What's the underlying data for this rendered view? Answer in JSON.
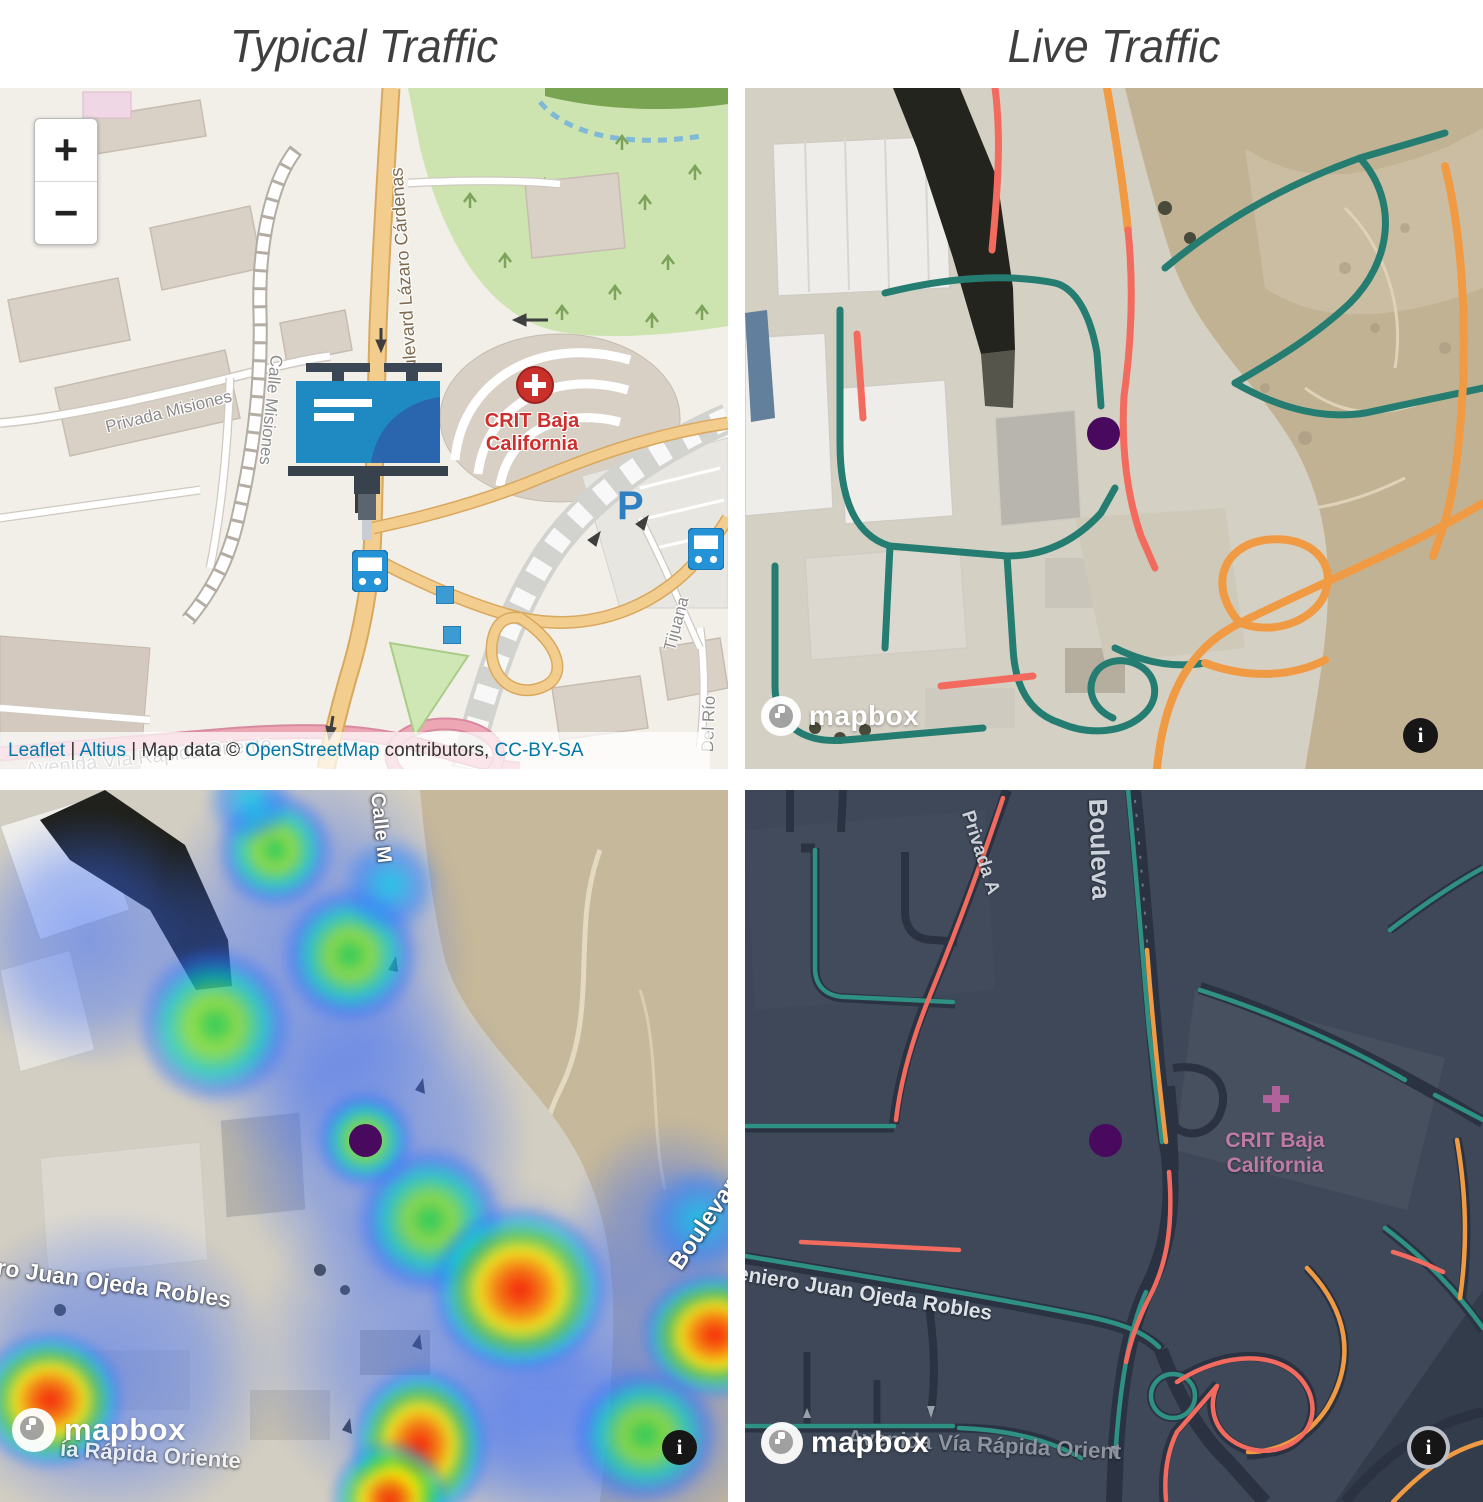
{
  "titles": {
    "typical": "Typical Traffic",
    "live": "Live Traffic"
  },
  "colors": {
    "traffic_teal": "#257d72",
    "traffic_orange": "#f09b43",
    "traffic_red": "#f26b5e",
    "marker_purple": "#49095f",
    "dark_map_bg": "#3e4858",
    "osm_main_road": "#f3cd8d",
    "osm_fast_road_pink": "#eda6b4",
    "park_green": "#cde4b0",
    "link_blue": "#0078a8",
    "poi_red": "#cc2f2c",
    "poi_pink": "#c07ba4"
  },
  "osm_map": {
    "zoom_in": "+",
    "zoom_out": "−",
    "poi_crit": "CRIT Baja California",
    "parking": "P",
    "street_privada_misiones": "Privada Misiones",
    "street_calle_misiones": "Calle Misiones",
    "street_boulevard": "Boulevard Lázaro Cárdenas",
    "street_avenida": "Avenida Vía Rápida Oriente",
    "street_del_rio": "Del Río",
    "street_tijuana": "Tijuana",
    "attribution": {
      "leaflet": "Leaflet",
      "sep1": "|",
      "altius": "Altius",
      "sep2": "| Map data ©",
      "osm": "OpenStreetMap",
      "contributors": "contributors,",
      "license": "CC-BY-SA"
    }
  },
  "heat_map": {
    "street_juan_ojeda": "ero Juan Ojeda Robles",
    "street_boulevard": "Boulevard Lázaro Cárdenas",
    "street_calle_fragment": "Calle M",
    "street_avenida_fragment": "ía Rápida Oriente"
  },
  "dark_map": {
    "street_privada": "Privada A",
    "street_boulevard": "Bouleva",
    "poi_crit": "CRIT Baja California",
    "street_juan_ojeda": "eniero Juan Ojeda Robles",
    "street_avenida": "Avenida Vía Rápida Orient"
  },
  "brand": {
    "mapbox": "mapbox",
    "info_glyph": "i"
  }
}
